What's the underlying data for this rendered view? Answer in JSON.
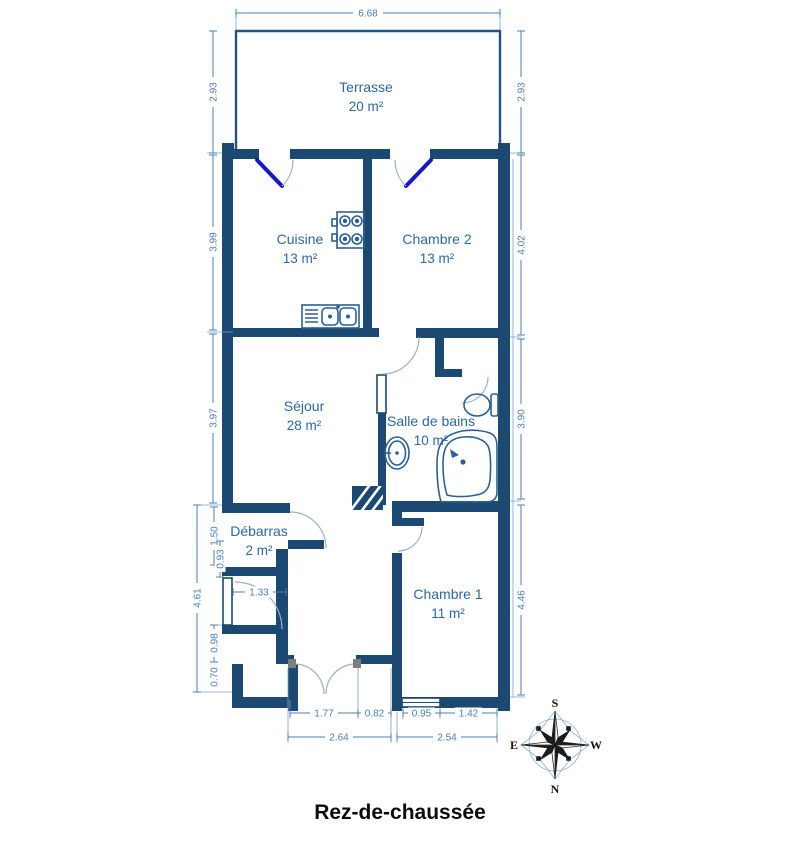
{
  "title": {
    "text": "Rez-de-chaussée"
  },
  "plan_type": "floor-plan",
  "colors": {
    "wall": "#1b4971",
    "dimension_line": "#4a7db8",
    "room_label": "#2c67a5",
    "door_leaf": "#1418c8",
    "door_arc": "#9fb0c2",
    "fixture_stroke": "#2b6094",
    "title_text": "#0c0c0c"
  },
  "rooms": [
    {
      "id": "terrasse",
      "name": "Terrasse",
      "area": "20 m²"
    },
    {
      "id": "cuisine",
      "name": "Cuisine",
      "area": "13 m²"
    },
    {
      "id": "chambre2",
      "name": "Chambre 2",
      "area": "13 m²"
    },
    {
      "id": "sejour",
      "name": "Séjour",
      "area": "28 m²"
    },
    {
      "id": "salle-de-bains",
      "name": "Salle de bains",
      "area": "10 m²"
    },
    {
      "id": "debarras",
      "name": "Débarras",
      "area": "2 m²"
    },
    {
      "id": "chambre1",
      "name": "Chambre 1",
      "area": "11 m²"
    }
  ],
  "dimensions": [
    {
      "id": "terrace-width",
      "value": "6.68"
    },
    {
      "id": "terrace-left-depth",
      "value": "2.93"
    },
    {
      "id": "terrace-right-depth",
      "value": "2.93"
    },
    {
      "id": "cuisine-left-height",
      "value": "3.99"
    },
    {
      "id": "chambre2-right-height",
      "value": "4.02"
    },
    {
      "id": "sejour-left-height",
      "value": "3.97"
    },
    {
      "id": "bains-right-height",
      "value": "3.90"
    },
    {
      "id": "lower-left-total",
      "value": "4.61"
    },
    {
      "id": "debarras-height",
      "value": "1.50"
    },
    {
      "id": "debarras-sub",
      "value": "0.93"
    },
    {
      "id": "debarras-width",
      "value": "1.33"
    },
    {
      "id": "vestibule-upper",
      "value": "0.98"
    },
    {
      "id": "vestibule-lower",
      "value": "0.70"
    },
    {
      "id": "chambre1-right-height",
      "value": "4.46"
    },
    {
      "id": "entry-door-width",
      "value": "1.77"
    },
    {
      "id": "entry-side-wall",
      "value": "0.82"
    },
    {
      "id": "entry-total-width",
      "value": "2.64"
    },
    {
      "id": "chambre1-window",
      "value": "0.95"
    },
    {
      "id": "chambre1-wall",
      "value": "1.42"
    },
    {
      "id": "chambre1-total-width",
      "value": "2.54"
    }
  ],
  "compass": {
    "north": "N",
    "south": "S",
    "east": "E",
    "west": "W"
  },
  "fixtures": [
    "stove",
    "kitchen-sink",
    "washbasin",
    "toilet",
    "corner-bathtub",
    "duct-hatch"
  ]
}
